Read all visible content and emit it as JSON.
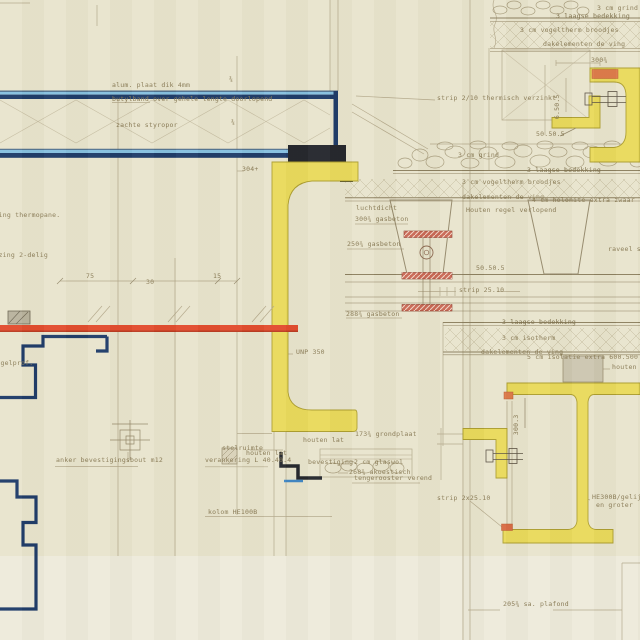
{
  "colors": {
    "paper": "#e8e4cd",
    "paper_light": "#edeadb",
    "pencil": "#b3a88a",
    "pencil_dark": "#94886a",
    "ink_text": "#8a7c57",
    "navy_blue": "#1d3a68",
    "light_blue": "#85c0e0",
    "steel_black": "#23262c",
    "profile_yellow": "#e9da5b",
    "yellow_edge": "#ac9d2e",
    "glazing_red": "#e24b2d",
    "anchor_red": "#c96753",
    "accent_orange": "#dd7a4a",
    "block_grey": "#c6c0ab"
  },
  "labels": {
    "alum_plaat": "alum. plaat dik 4mm",
    "butylband": "butylband over gehele lengte doorlopend",
    "zachte_styropor": "zachte styropor",
    "beglazing_thermopane": "beglazing thermopane.",
    "beglazing_2delig": "beglazing 2-delig",
    "vleugelprof": "vleugelprof.",
    "strip_2_10": "strip 2/10 thermisch verzinkt",
    "dim_304": "304+",
    "tick_a": "¾",
    "tick_b": "¾",
    "grind_top": "3 cm grind",
    "bedekking_top": "3 laagse bedekking",
    "vogeltherm_top": "3 cm vogeltherm broodjes",
    "dakelementen_top": "dakelementen de ving",
    "dim_300": "300¾",
    "dim_650": "6.50.5",
    "hoek_50505_top": "50.50.5",
    "grind_mid": "3 cm grind",
    "bedekking_mid": "3 laagse bedekking",
    "vogeltherm_mid": "3 cm vogeltherm broodjes",
    "dakelementen_mid": "dakelementen de ving",
    "holonite": "4 cm holonite extra zwaar",
    "houten_regel_verlopend": "Houten regel verlopend",
    "luchtdicht": "luchtdicht",
    "gasbeton_300": "300¾ gasbeton",
    "gasbeton_250": "250¾ gasbeton",
    "hoek_50505_mid": "50.50.5",
    "strip_2510": "strip 25.10",
    "gasbeton_288": "288¾ gasbeton",
    "raveel": "raveel st.",
    "bedekking_laag": "3 laagse bedekking",
    "isotherm": "3 cm isotherm",
    "dakelementen_laag": "dakelementen de ving",
    "isolatie_600500": "5 cm isolatie extra 600.500",
    "houten_regel": "houten regel",
    "dim_3003": "300.3",
    "unp_350": "UNP 350",
    "stelruimte": "stelruimte",
    "houten_lat_1": "houten lat",
    "houten_lat_2": "houten lat",
    "verankering": "verankering L 40.40.4",
    "grondplaat_173": "173¾ grondplaat",
    "bevestiging": "bevestiging",
    "glaswol": "2 cm glaswol",
    "akoestisch_268": "268¾ akoestisch",
    "tengerooster": "tengerooster verend",
    "kolom_he100b": "kolom HE100B",
    "anker": "anker bevestigingsbout m12",
    "he300b": "HE300B/gelijkw.",
    "he300b_2": "en groter",
    "strip_2x2510": "strip 2x25.10",
    "sa_plafond": "205¾ sa. plafond",
    "dim_75": "75",
    "dim_30": "30",
    "dim_15": "15"
  }
}
